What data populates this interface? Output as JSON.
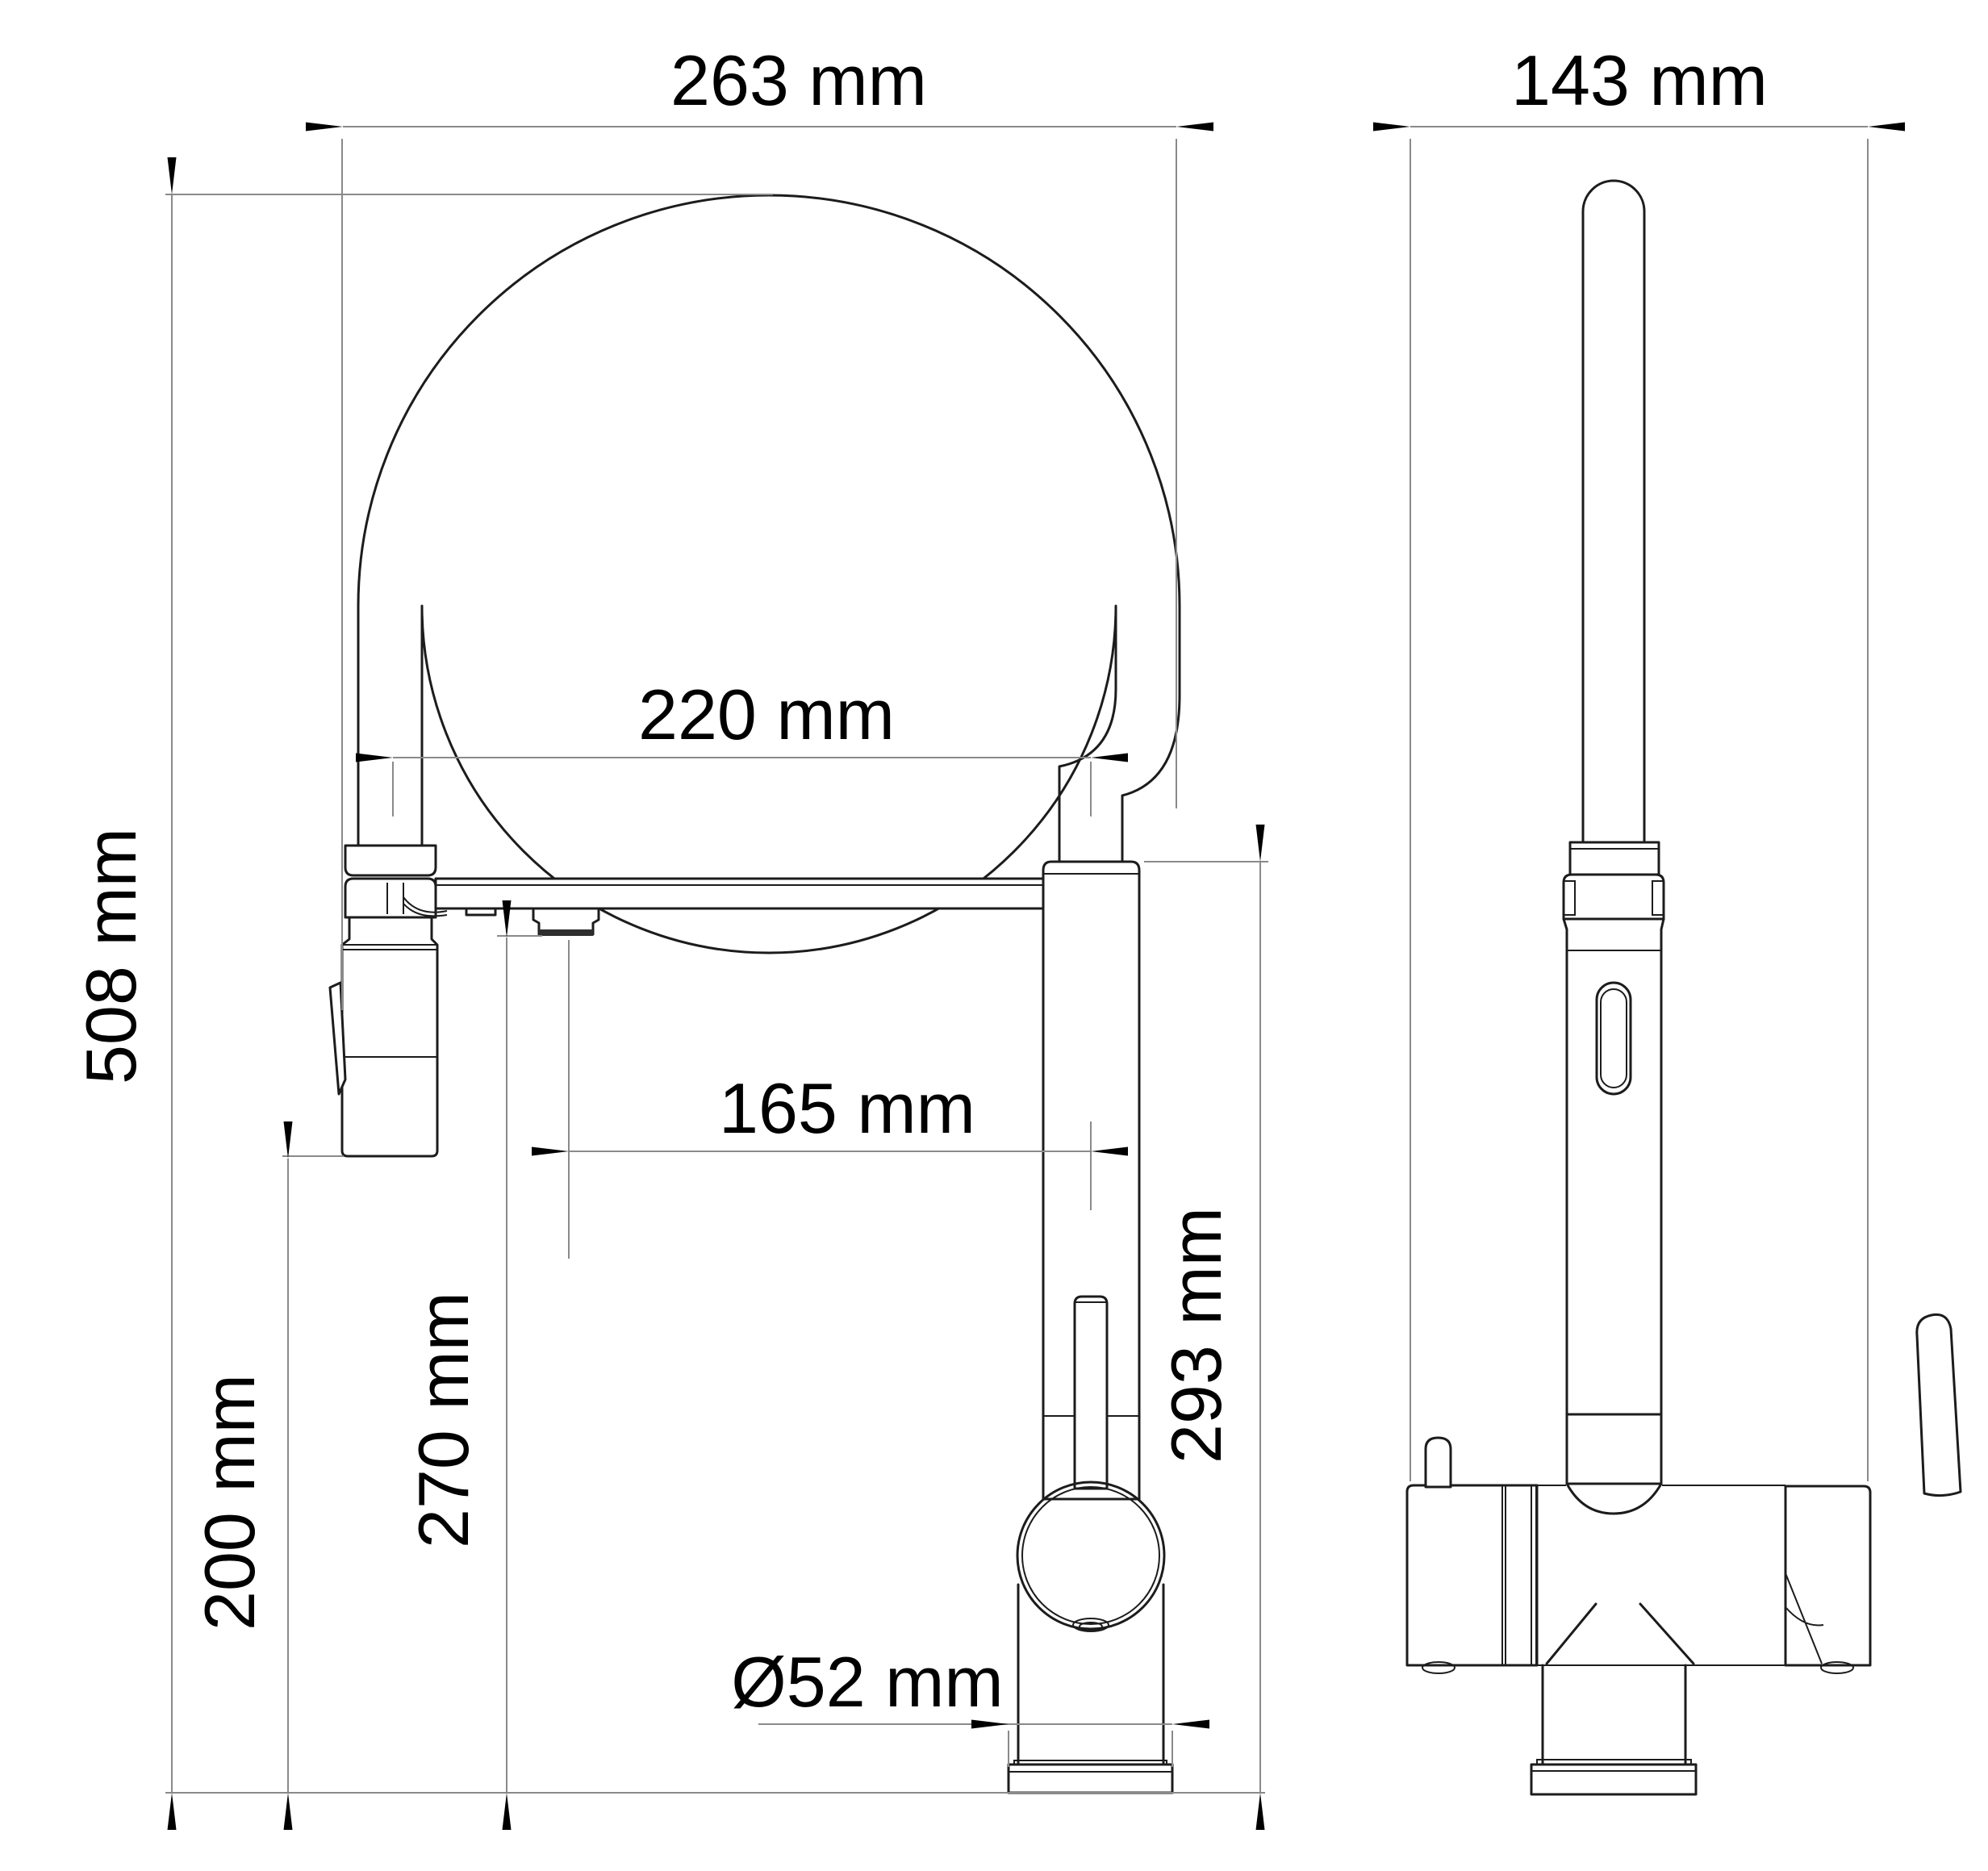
{
  "page": {
    "title": "Kitchen faucet dimensional drawing",
    "background_color": "#ffffff",
    "part_line_color": "#1c1c1c",
    "dimension_line_color": "#8a8a8a",
    "text_color": "#000000"
  },
  "views": [
    {
      "id": "front",
      "name": "front view"
    },
    {
      "id": "side",
      "name": "side view"
    }
  ],
  "dimensions": {
    "overall_width": {
      "label": "263 mm",
      "value": 263,
      "unit": "mm",
      "orientation": "horizontal",
      "view": "front"
    },
    "spout_span": {
      "label": "220 mm",
      "value": 220,
      "unit": "mm",
      "orientation": "horizontal",
      "view": "front"
    },
    "nozzle_reach": {
      "label": "165 mm",
      "value": 165,
      "unit": "mm",
      "orientation": "horizontal",
      "view": "front"
    },
    "overall_height": {
      "label": "508 mm",
      "value": 508,
      "unit": "mm",
      "orientation": "vertical",
      "view": "front"
    },
    "head_clearance": {
      "label": "200 mm",
      "value": 200,
      "unit": "mm",
      "orientation": "vertical",
      "view": "front"
    },
    "outlet_height": {
      "label": "270 mm",
      "value": 270,
      "unit": "mm",
      "orientation": "vertical",
      "view": "front"
    },
    "body_height": {
      "label": "293 mm",
      "value": 293,
      "unit": "mm",
      "orientation": "vertical",
      "view": "front"
    },
    "base_diameter": {
      "label": "Ø52 mm",
      "value": 52,
      "unit": "mm",
      "orientation": "horizontal",
      "view": "front"
    },
    "side_width": {
      "label": "143 mm",
      "value": 143,
      "unit": "mm",
      "orientation": "horizontal",
      "view": "side"
    }
  }
}
